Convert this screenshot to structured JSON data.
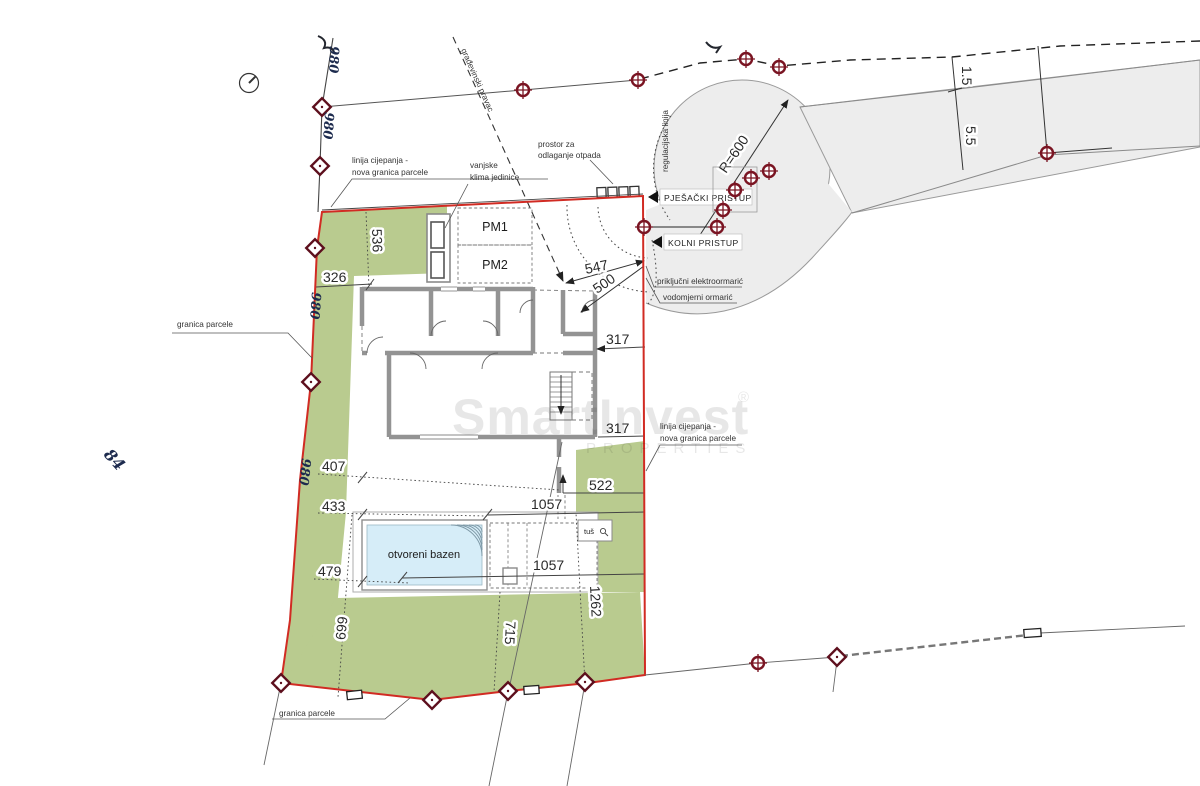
{
  "colors": {
    "parcel_green": "#b9cb8f",
    "road_gray": "#ededed",
    "boundary_red": "#d12b23",
    "marker_maroon": "#7a1422",
    "wall_gray": "#939393",
    "pool_blue": "#d6edf8"
  },
  "labels": {
    "granica_parcele": "granica parcele",
    "granica_parcele_bottom": "granica parcele",
    "linija_cijepanja_1": "linija cijepanja -",
    "linija_cijepanja_2": "nova granica parcele",
    "linija_cijepanja_r1": "linija cijepanja -",
    "linija_cijepanja_r2": "nova granica parcele",
    "vanjske_klima_1": "vanjske",
    "vanjske_klima_2": "klima jedinice",
    "otpad_1": "prostor za",
    "otpad_2": "odlaganje otpada",
    "regulacijska": "regulacijska linija",
    "gradevinski": "građevinski pravac",
    "pjesacki": "PJEŠAČKI PRISTUP",
    "kolni": "KOLNI PRISTUP",
    "elektro": "priključni elektroormarić",
    "vodomjerni": "vodomjerni ormarić",
    "bazen": "otvoreni bazen",
    "tus": "tuš"
  },
  "parking": {
    "pm1": "PM1",
    "pm2": "PM2"
  },
  "dimensions": {
    "d536": "536",
    "d326": "326",
    "d407": "407",
    "d433": "433",
    "d479": "479",
    "d669": "669",
    "d715": "715",
    "d1262": "1262",
    "d522": "522",
    "d1057a": "1057",
    "d1057b": "1057",
    "d317a": "317",
    "d317b": "317",
    "d547": "547",
    "d500": "500",
    "sidewalk_width": "1.5",
    "road_width": "5.5",
    "turn_radius": "R=600"
  },
  "annotations": {
    "plot_84": "84",
    "survey_mark": "980"
  },
  "watermark": {
    "brand": "SmartInvest",
    "reg": "®",
    "sub": "PROPERTIES"
  }
}
